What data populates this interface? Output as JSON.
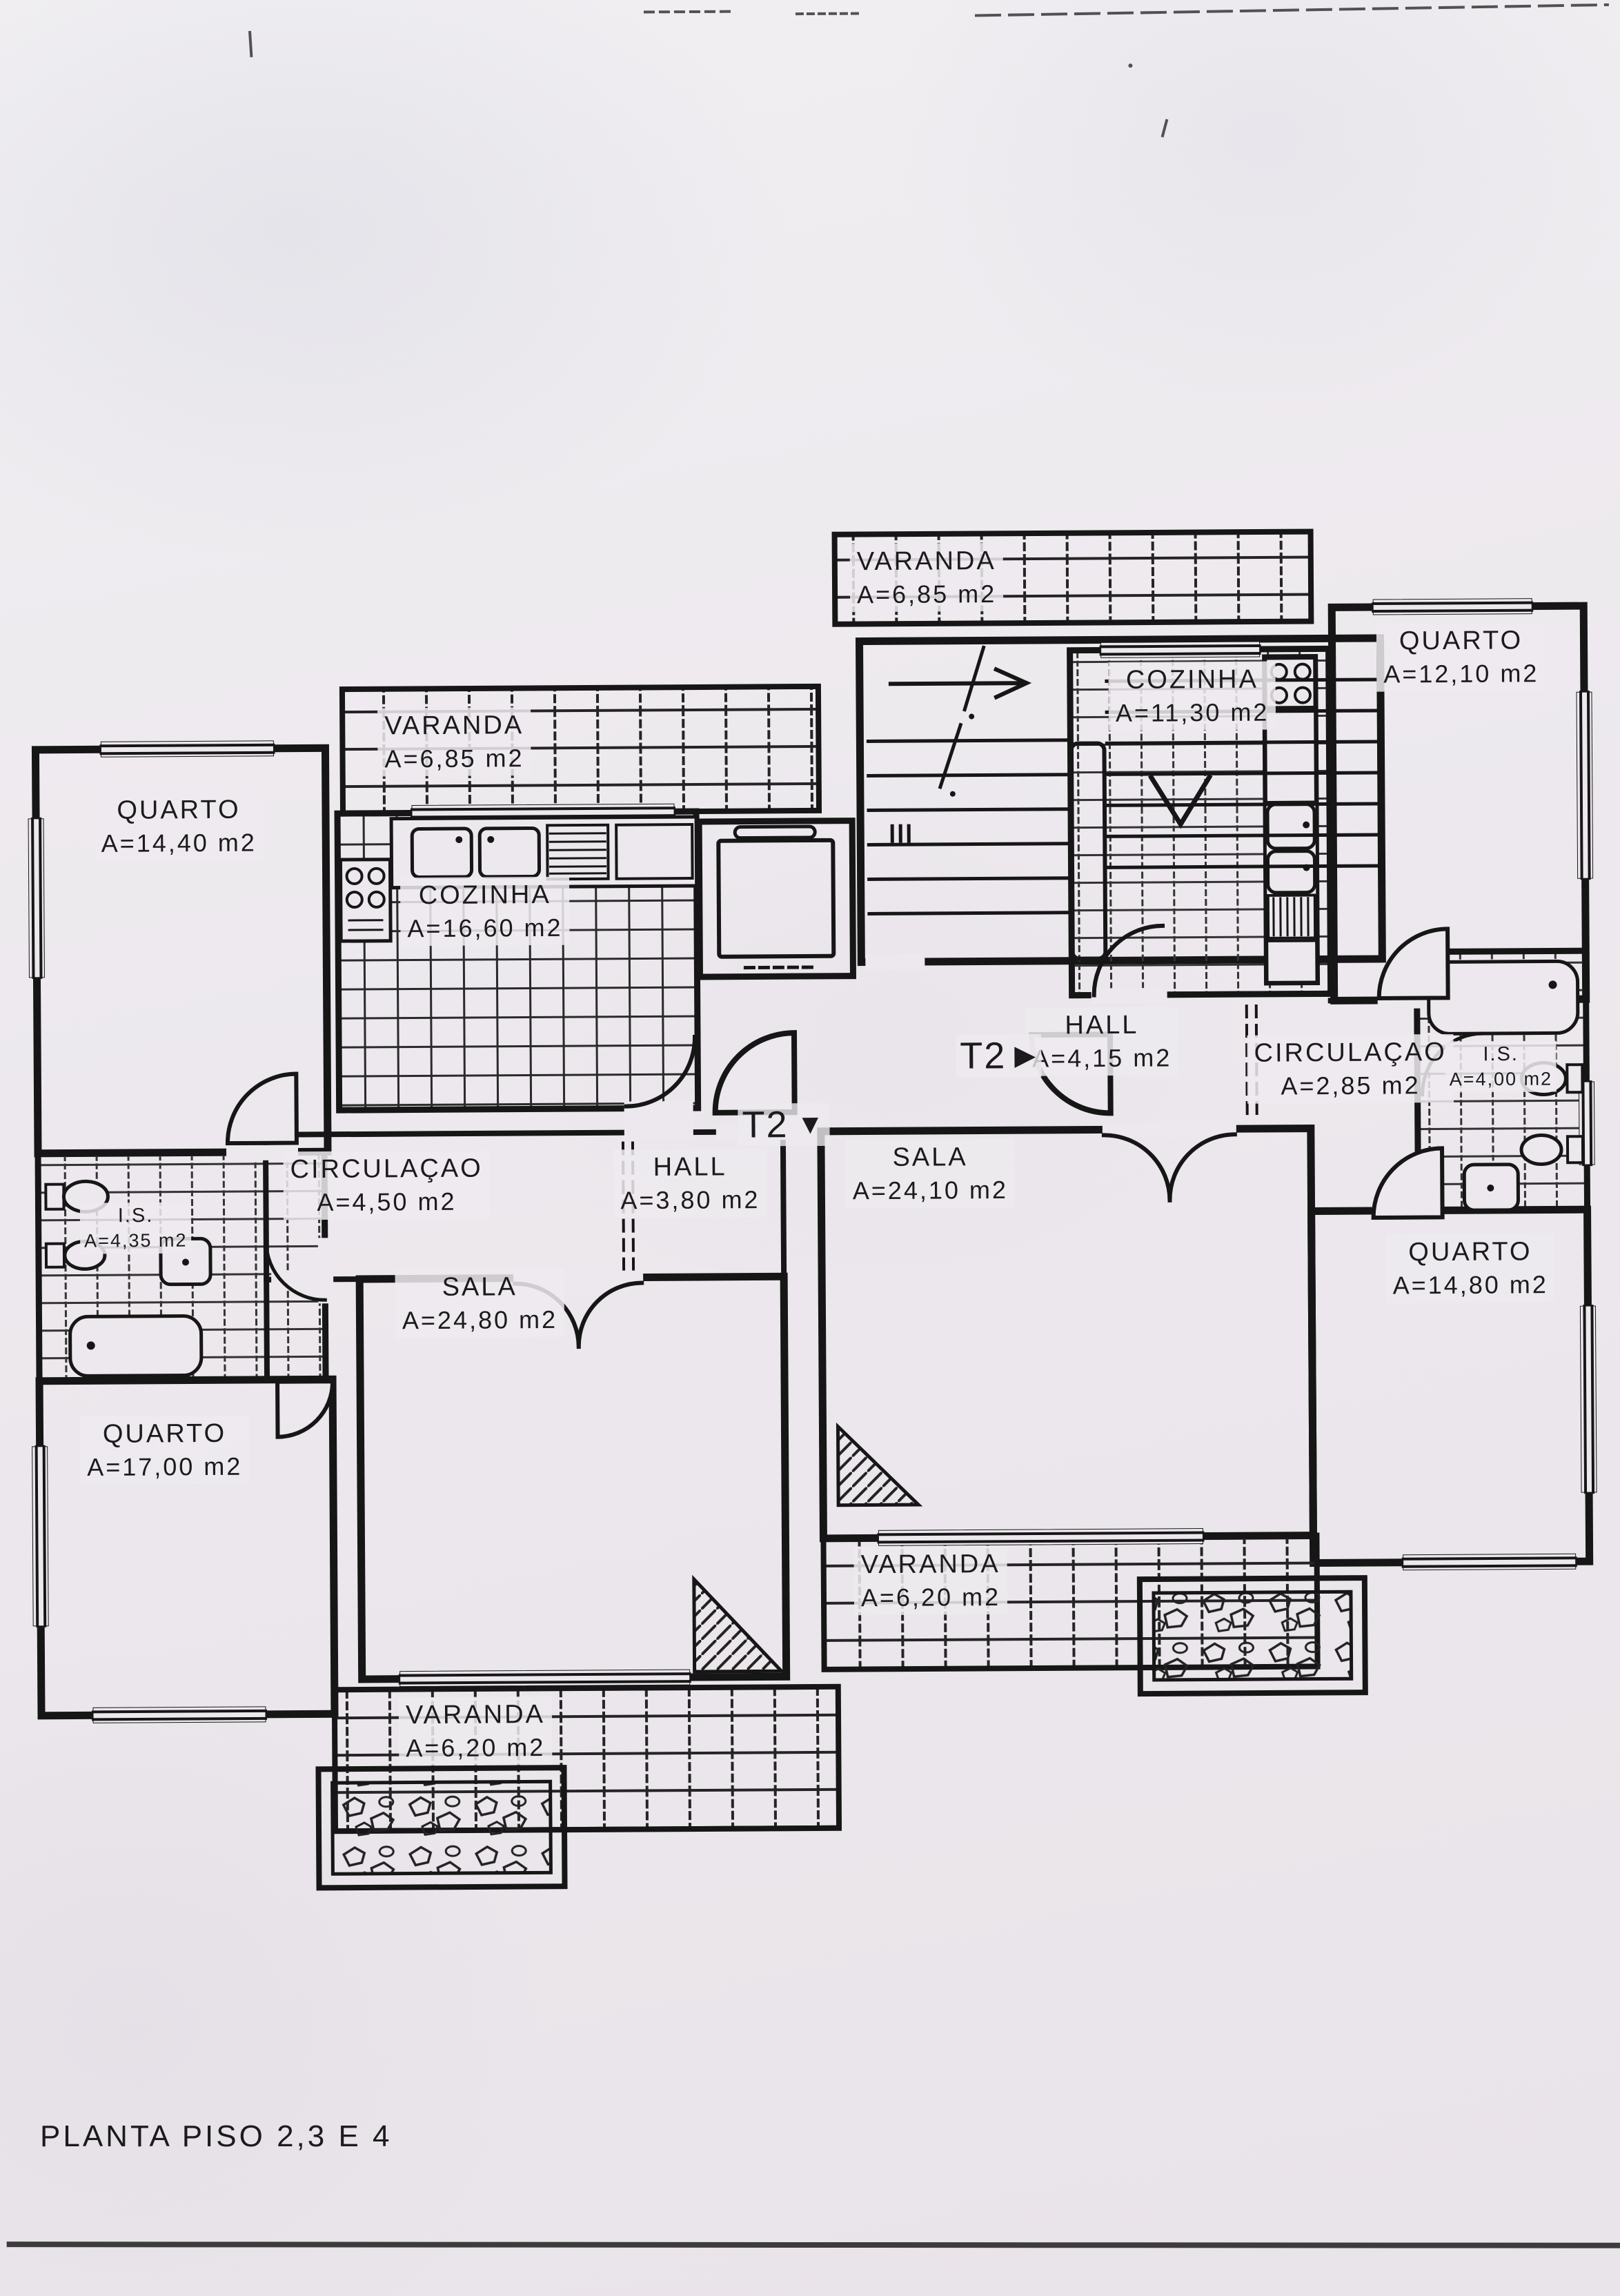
{
  "title": "PLANTA PISO 2,3 E 4",
  "markers": {
    "left": {
      "label": "T2",
      "glyph": "▼"
    },
    "right": {
      "label": "T2",
      "glyph": "▶"
    }
  },
  "rooms": [
    {
      "id": "varanda-left",
      "name": "VARANDA",
      "area": "A=6,85 m2"
    },
    {
      "id": "quarto-14-40",
      "name": "QUARTO",
      "area": "A=14,40 m2"
    },
    {
      "id": "cozinha-16-60",
      "name": "COZINHA",
      "area": "A=16,60 m2"
    },
    {
      "id": "varanda-top",
      "name": "VARANDA",
      "area": "A=6,85 m2"
    },
    {
      "id": "cozinha-11-30",
      "name": "COZINHA",
      "area": "A=11,30 m2"
    },
    {
      "id": "quarto-12-10",
      "name": "QUARTO",
      "area": "A=12,10 m2"
    },
    {
      "id": "hall-4-15",
      "name": "HALL",
      "area": "A=4,15 m2"
    },
    {
      "id": "circulacao-2-85",
      "name": "CIRCULAÇAO",
      "area": "A=2,85 m2"
    },
    {
      "id": "is-4-00",
      "name": "I.S.",
      "area": "A=4,00 m2"
    },
    {
      "id": "sala-24-10",
      "name": "SALA",
      "area": "A=24,10 m2"
    },
    {
      "id": "quarto-14-80",
      "name": "QUARTO",
      "area": "A=14,80 m2"
    },
    {
      "id": "circulacao-4-50",
      "name": "CIRCULAÇAO",
      "area": "A=4,50 m2"
    },
    {
      "id": "hall-3-80",
      "name": "HALL",
      "area": "A=3,80 m2"
    },
    {
      "id": "is-4-35",
      "name": "I.S.",
      "area": "A=4,35 m2"
    },
    {
      "id": "sala-24-80",
      "name": "SALA",
      "area": "A=24,80 m2"
    },
    {
      "id": "quarto-17-00",
      "name": "QUARTO",
      "area": "A=17,00 m2"
    },
    {
      "id": "varanda-6-20-right",
      "name": "VARANDA",
      "area": "A=6,20 m2"
    },
    {
      "id": "varanda-6-20-left",
      "name": "VARANDA",
      "area": "A=6,20 m2"
    }
  ]
}
